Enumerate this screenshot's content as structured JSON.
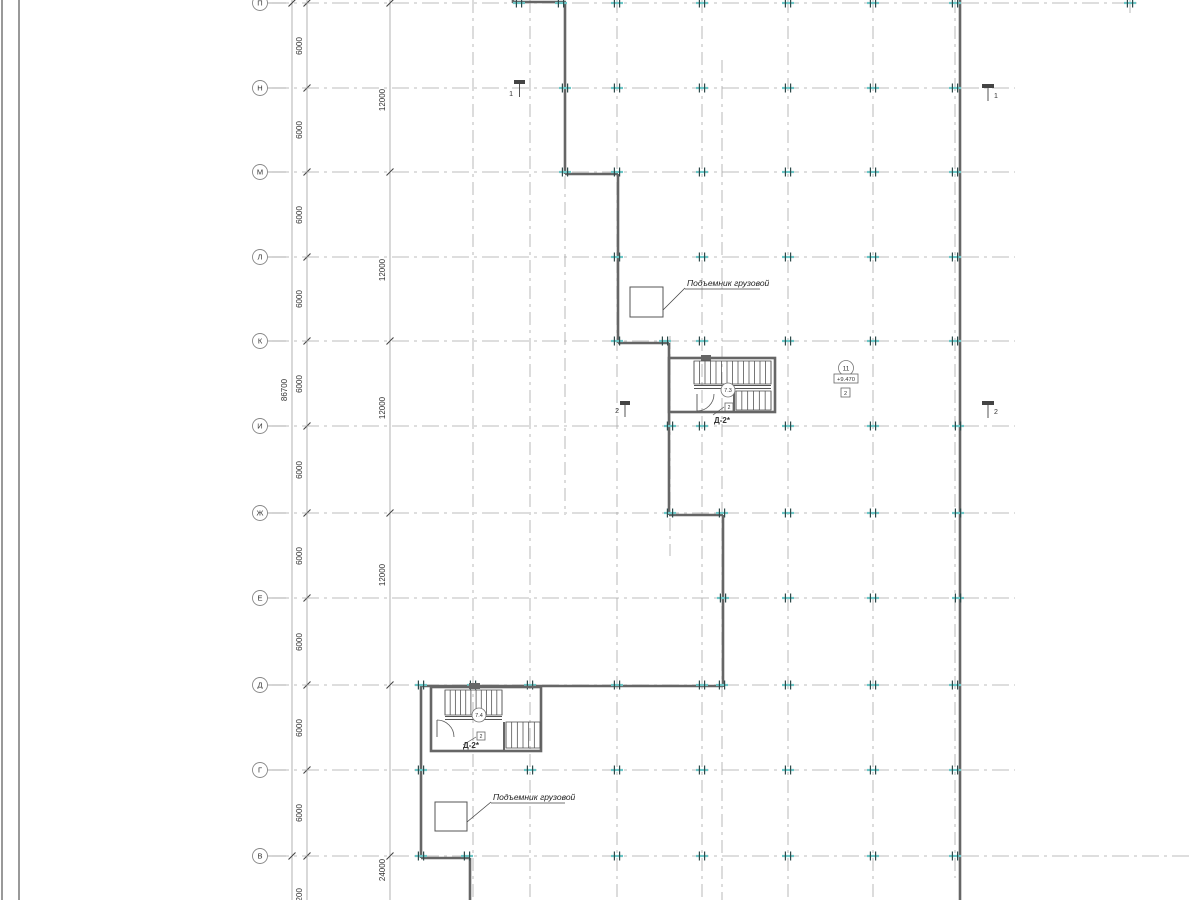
{
  "title": "Floor plan drawing",
  "colors": {
    "wall": "#666666",
    "grid": "#a8a8a8",
    "chain": "#929292",
    "slash": "#444444",
    "teal_band": "#6cc7c7",
    "tick_dark": "#2e4a4a",
    "text": "#333333",
    "stair": "#555555",
    "annot": "#222222",
    "frame": "#333333"
  },
  "axes": {
    "circle_x": 260,
    "circle_r": 7.5,
    "rows": [
      {
        "label": "П",
        "y": 3
      },
      {
        "label": "Н",
        "y": 88
      },
      {
        "label": "М",
        "y": 172
      },
      {
        "label": "Л",
        "y": 257
      },
      {
        "label": "К",
        "y": 341
      },
      {
        "label": "И",
        "y": 426
      },
      {
        "label": "Ж",
        "y": 513
      },
      {
        "label": "Е",
        "y": 598
      },
      {
        "label": "Д",
        "y": 685
      },
      {
        "label": "Г",
        "y": 770
      },
      {
        "label": "В",
        "y": 856
      }
    ],
    "row_x1": 272,
    "row_x2_default": 1015,
    "row_x2_overrides": {
      "П": 1140,
      "В": 1190
    },
    "columns": [
      {
        "x": 473,
        "y1": 0,
        "y2": 900
      },
      {
        "x": 530,
        "y1": 0,
        "y2": 900
      },
      {
        "x": 565,
        "y1": 176,
        "y2": 515
      },
      {
        "x": 617,
        "y1": 0,
        "y2": 900
      },
      {
        "x": 670,
        "y1": 336,
        "y2": 556
      },
      {
        "x": 702,
        "y1": 0,
        "y2": 900
      },
      {
        "x": 722,
        "y1": 60,
        "y2": 900
      },
      {
        "x": 788,
        "y1": 0,
        "y2": 900
      },
      {
        "x": 873,
        "y1": 0,
        "y2": 900
      },
      {
        "x": 955,
        "y1": 0,
        "y2": 878
      },
      {
        "x": 1130,
        "y1": 0,
        "y2": 18
      }
    ]
  },
  "dimension_chains": [
    {
      "x": 292,
      "y1": 0,
      "y2": 900,
      "texts": [
        {
          "y": 390,
          "t": "86700"
        }
      ],
      "slashes": [
        3,
        856
      ]
    },
    {
      "x": 307,
      "y1": 0,
      "y2": 900,
      "texts": [
        {
          "y": 46,
          "t": "6000"
        },
        {
          "y": 130,
          "t": "6000"
        },
        {
          "y": 215,
          "t": "6000"
        },
        {
          "y": 299,
          "t": "6000"
        },
        {
          "y": 384,
          "t": "6000"
        },
        {
          "y": 470,
          "t": "6000"
        },
        {
          "y": 556,
          "t": "6000"
        },
        {
          "y": 642,
          "t": "6000"
        },
        {
          "y": 728,
          "t": "6000"
        },
        {
          "y": 813,
          "t": "6000"
        },
        {
          "y": 897,
          "t": "7200"
        }
      ],
      "slashes": [
        3,
        88,
        172,
        257,
        341,
        426,
        513,
        598,
        685,
        770,
        856
      ]
    },
    {
      "x": 390,
      "y1": 0,
      "y2": 900,
      "texts": [
        {
          "y": 100,
          "t": "12000"
        },
        {
          "y": 270,
          "t": "12000"
        },
        {
          "y": 408,
          "t": "12000"
        },
        {
          "y": 575,
          "t": "12000"
        },
        {
          "y": 870,
          "t": "24000"
        }
      ],
      "slashes": [
        3,
        172,
        341,
        513,
        685,
        856
      ]
    }
  ],
  "walls": [
    [
      513,
      0,
      513,
      3
    ],
    [
      513,
      2,
      566,
      2
    ],
    [
      565,
      2,
      565,
      174
    ],
    [
      565,
      174,
      618,
      174
    ],
    [
      618,
      174,
      618,
      343
    ],
    [
      618,
      343,
      669,
      343
    ],
    [
      669,
      343,
      669,
      515
    ],
    [
      669,
      515,
      723,
      515
    ],
    [
      723,
      515,
      723,
      687
    ],
    [
      421,
      686,
      723,
      686
    ],
    [
      421,
      686,
      421,
      858
    ],
    [
      421,
      858,
      470,
      858
    ],
    [
      470,
      858,
      470,
      900
    ],
    [
      960,
      0,
      960,
      900
    ]
  ],
  "ticks": [
    [
      519,
      3
    ],
    [
      561,
      3
    ],
    [
      617,
      3
    ],
    [
      702,
      3
    ],
    [
      788,
      3
    ],
    [
      873,
      3
    ],
    [
      955,
      3
    ],
    [
      1130,
      3
    ],
    [
      565,
      88
    ],
    [
      617,
      88
    ],
    [
      702,
      88
    ],
    [
      788,
      88
    ],
    [
      873,
      88
    ],
    [
      955,
      88
    ],
    [
      565,
      172
    ],
    [
      617,
      172
    ],
    [
      702,
      172
    ],
    [
      788,
      172
    ],
    [
      873,
      172
    ],
    [
      955,
      172
    ],
    [
      617,
      257
    ],
    [
      702,
      257
    ],
    [
      788,
      257
    ],
    [
      873,
      257
    ],
    [
      955,
      257
    ],
    [
      617,
      341
    ],
    [
      665,
      341
    ],
    [
      702,
      341
    ],
    [
      788,
      341
    ],
    [
      873,
      341
    ],
    [
      955,
      341
    ],
    [
      670,
      426
    ],
    [
      702,
      426
    ],
    [
      788,
      426
    ],
    [
      873,
      426
    ],
    [
      958,
      426
    ],
    [
      670,
      513
    ],
    [
      722,
      513
    ],
    [
      788,
      513
    ],
    [
      873,
      513
    ],
    [
      958,
      513
    ],
    [
      723,
      598
    ],
    [
      788,
      598
    ],
    [
      873,
      598
    ],
    [
      958,
      598
    ],
    [
      421,
      685
    ],
    [
      473,
      685
    ],
    [
      530,
      685
    ],
    [
      617,
      685
    ],
    [
      702,
      685
    ],
    [
      722,
      685
    ],
    [
      788,
      685
    ],
    [
      873,
      685
    ],
    [
      955,
      685
    ],
    [
      421,
      770
    ],
    [
      530,
      770
    ],
    [
      617,
      770
    ],
    [
      702,
      770
    ],
    [
      788,
      770
    ],
    [
      873,
      770
    ],
    [
      955,
      770
    ],
    [
      421,
      856
    ],
    [
      467,
      856
    ],
    [
      617,
      856
    ],
    [
      702,
      856
    ],
    [
      788,
      856
    ],
    [
      873,
      856
    ],
    [
      955,
      856
    ]
  ],
  "stairs": [
    {
      "name": "stair-upper",
      "box": [
        669,
        358,
        106,
        54
      ],
      "inner_wall": [
        734,
        388,
        734,
        412
      ],
      "wall_block": [
        701,
        355,
        10,
        6
      ],
      "flight1": {
        "x1": 694,
        "x2": 771,
        "y1": 361,
        "y2": 384,
        "n": 15
      },
      "rail": {
        "x1": 694,
        "x2": 771,
        "ya": 385.5,
        "yb": 388.5
      },
      "flight2": {
        "x1": 736,
        "x2": 771,
        "y1": 391,
        "y2": 410,
        "n": 7
      },
      "door_arc": "M 697 411 A 17 17 0 0 0 714 394",
      "door_leaf": [
        697,
        394,
        697,
        411
      ],
      "marker_leader": [
        713,
        415,
        724,
        407
      ],
      "circle": {
        "x": 728,
        "y": 390,
        "r": 7,
        "t": "7.3"
      },
      "square": {
        "x": 725,
        "y": 403,
        "w": 8,
        "h": 8,
        "t": "2"
      },
      "label": {
        "x": 722,
        "y": 423,
        "t": "Д-2*"
      }
    },
    {
      "name": "stair-lower",
      "box": [
        431,
        687,
        110,
        64
      ],
      "inner_wall": [
        504,
        722,
        504,
        751
      ],
      "wall_block": [
        469,
        683,
        11,
        6
      ],
      "flight1": {
        "x1": 445,
        "x2": 502,
        "y1": 690,
        "y2": 715,
        "n": 12
      },
      "rail": {
        "x1": 445,
        "x2": 502,
        "ya": 716.5,
        "yb": 719.5
      },
      "flight2": {
        "x1": 506,
        "x2": 540,
        "y1": 722,
        "y2": 748,
        "n": 7
      },
      "door_arc": "M 437 720 A 17 17 0 0 1 454 737",
      "door_leaf": [
        437,
        720,
        437,
        737
      ],
      "marker_leader": [
        463,
        745,
        476,
        737
      ],
      "circle": {
        "x": 479,
        "y": 715,
        "r": 7,
        "t": "7.4"
      },
      "square": {
        "x": 477,
        "y": 732,
        "w": 8,
        "h": 8,
        "t": "2"
      },
      "label": {
        "x": 471,
        "y": 748,
        "t": "Д-2*"
      }
    }
  ],
  "lifts": [
    {
      "name": "freight-lift-upper",
      "box": [
        630,
        287,
        33,
        30
      ],
      "leader": [
        663,
        310,
        685,
        288
      ],
      "underline": [
        685,
        289,
        760,
        289
      ],
      "text": {
        "x": 687,
        "y": 286,
        "t": "Подъемник грузовой"
      }
    },
    {
      "name": "freight-lift-lower",
      "box": [
        435,
        802,
        32,
        29
      ],
      "leader": [
        467,
        822,
        491,
        802
      ],
      "underline": [
        491,
        803,
        565,
        803
      ],
      "text": {
        "x": 493,
        "y": 800,
        "t": "Подъемник грузовой"
      }
    }
  ],
  "level_marker": {
    "circle": {
      "x": 846,
      "y": 368,
      "r": 7.5,
      "t": "11"
    },
    "box": {
      "x": 834,
      "y": 374,
      "w": 24,
      "h": 9,
      "t": "+9.470"
    },
    "square": {
      "x": 841,
      "y": 388,
      "w": 9,
      "h": 9,
      "t": "2"
    }
  },
  "section_flags": [
    {
      "name": "section-1-left",
      "bar": [
        514,
        80,
        11,
        4
      ],
      "stem": [
        519.5,
        84,
        519.5,
        97
      ],
      "label": "1",
      "lx": 513,
      "ly": 96,
      "anchor": "end"
    },
    {
      "name": "section-1-right",
      "bar": [
        982,
        84,
        12,
        4
      ],
      "stem": [
        988,
        88,
        988,
        101
      ],
      "label": "1",
      "lx": 994,
      "ly": 98,
      "anchor": "start"
    },
    {
      "name": "section-2-left",
      "bar": [
        620,
        401,
        10,
        4
      ],
      "stem": [
        625,
        405,
        625,
        417
      ],
      "label": "2",
      "lx": 619,
      "ly": 413,
      "anchor": "end"
    },
    {
      "name": "section-2-right",
      "bar": [
        982,
        401,
        12,
        4
      ],
      "stem": [
        988,
        405,
        988,
        418
      ],
      "label": "2",
      "lx": 994,
      "ly": 414,
      "anchor": "start"
    }
  ],
  "frame_lines_x": [
    2,
    19
  ]
}
